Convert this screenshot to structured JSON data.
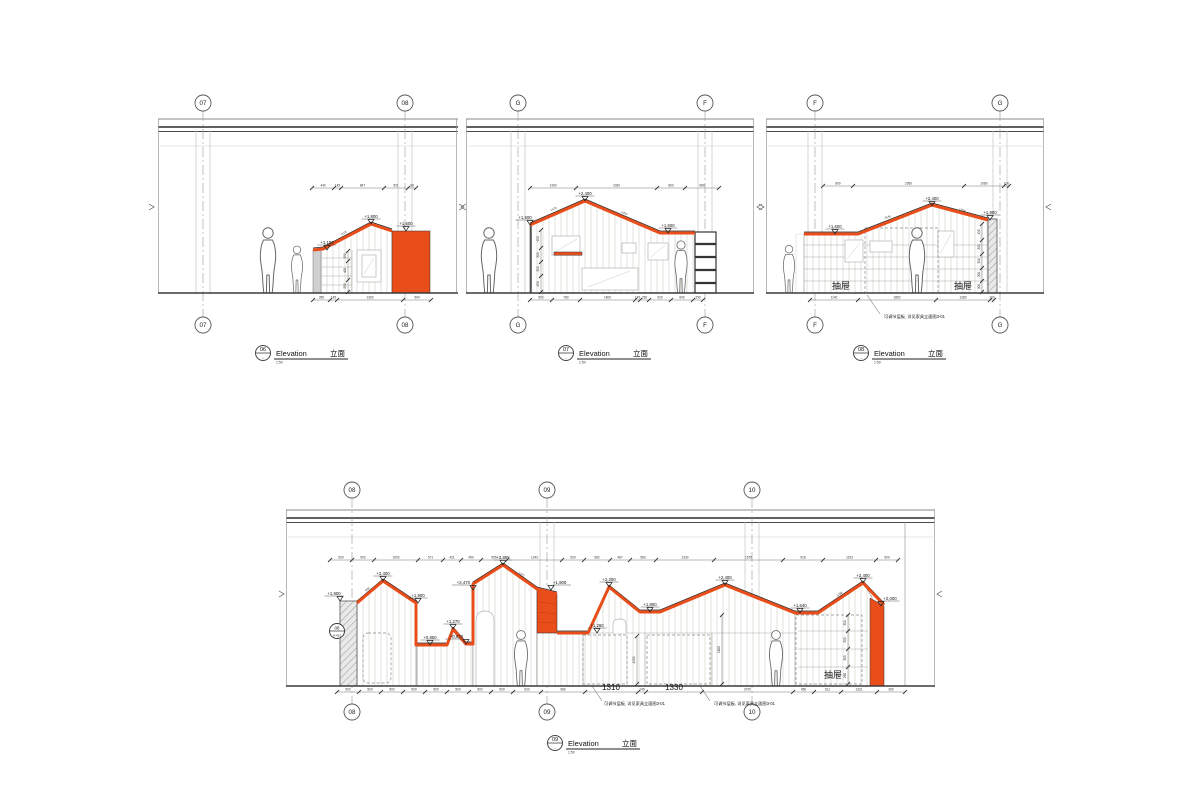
{
  "colors": {
    "accent_orange": "#e94d1a",
    "line_dark": "#3a3a3a",
    "line_light": "#bbbbbb"
  },
  "e06": {
    "grids": [
      "07",
      "08"
    ],
    "title": {
      "num": "06",
      "sub": "-",
      "label": "Elevation",
      "cn": "立面",
      "scale": "1:50"
    },
    "levels": [
      "+1,100",
      "+1,800",
      "+1,600"
    ],
    "dims_top": [
      "440",
      "145",
      "847",
      "501",
      "98"
    ],
    "dims_bottom": [
      "350",
      "145",
      "1393",
      "594"
    ],
    "vdim": [
      "250",
      "400",
      "250"
    ],
    "slope_dims": [
      "1118"
    ]
  },
  "e07": {
    "grids": [
      "G",
      "F"
    ],
    "title": {
      "num": "07",
      "sub": "-",
      "label": "Elevation",
      "cn": "立面",
      "scale": "1:50"
    },
    "levels": [
      "+1,500",
      "+2,400",
      "+1,600"
    ],
    "dims_top": [
      "1330",
      "2330",
      "800",
      "980"
    ],
    "dims_bottom": [
      "650",
      "780",
      "1600",
      "145",
      "260",
      "620",
      "640",
      "290"
    ],
    "vdim": [
      "450",
      "300",
      "300",
      "450"
    ],
    "slope_dims": [
      "1475",
      "2404"
    ]
  },
  "e08": {
    "grids": [
      "F",
      "G"
    ],
    "title": {
      "num": "08",
      "sub": "-",
      "label": "Elevation",
      "cn": "立面",
      "scale": "1:50"
    },
    "levels": [
      "+1,600",
      "+2,400",
      "+1,900"
    ],
    "dims_top": [
      "800",
      "2950",
      "1080",
      "100"
    ],
    "dims_bottom": [
      "1140",
      "1852",
      "1280",
      "100"
    ],
    "vdim": [
      "450",
      "300",
      "300",
      "300",
      "300"
    ],
    "drawers": [
      "抽屉",
      "抽屉"
    ],
    "note": "可调节层板, 详见家具立面图3-01",
    "slope_dims": [
      "2646",
      "1754"
    ]
  },
  "e09": {
    "grids": [
      "08",
      "09",
      "10"
    ],
    "title": {
      "num": "09",
      "sub": "-",
      "label": "Elevation",
      "cn": "立面",
      "scale": "1:50"
    },
    "levels": [
      "+1,900",
      "+2,400",
      "+1,900",
      "+0,850",
      "+1,270",
      "+0,870",
      "+2,470",
      "+2,855",
      "+1,900",
      "+1,260",
      "+2,300",
      "+1,800",
      "+2,400",
      "+1,640",
      "+2,400",
      "+2,000"
    ],
    "dims_top": [
      "500",
      "500",
      "1000",
      "571",
      "421",
      "450",
      "595",
      "1243",
      "500",
      "582",
      "467",
      "583",
      "1330",
      "1575",
      "916",
      "1193",
      "500"
    ],
    "dims_bottom": [
      "500",
      "500",
      "500",
      "500",
      "500",
      "500",
      "500",
      "500",
      "620",
      "980",
      "",
      "145",
      "",
      "2070",
      "450",
      "611",
      "1321",
      "260"
    ],
    "big_dims": [
      "1310",
      "1330"
    ],
    "vdims": {
      "a": [
        "1200"
      ],
      "b": [
        "1600"
      ]
    },
    "vdim_right": [
      "300",
      "300",
      "300",
      "260"
    ],
    "drawer": "抽屉",
    "notes": [
      "可调节层板, 详见家具立面图3-01",
      "可调节层板, 详见家具立面图3-01"
    ],
    "section": {
      "top": "08",
      "bottom": "A-413"
    },
    "slope_dims": [
      "560",
      "1473",
      "1288"
    ]
  }
}
